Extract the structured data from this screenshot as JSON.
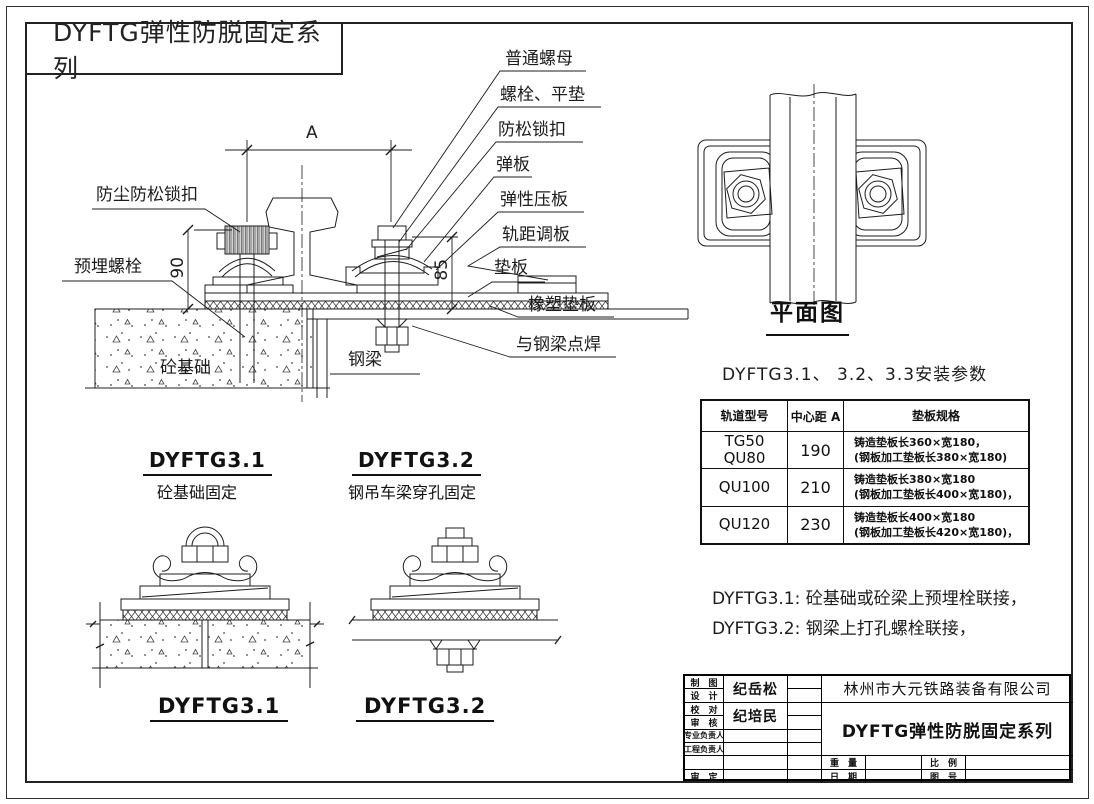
{
  "sheet": {
    "series_title": "DYFTG弹性防脱固定系列"
  },
  "colors": {
    "line": "#1c1c1c",
    "background": "#ffffff"
  },
  "main_view": {
    "callouts": [
      "普通螺母",
      "螺栓、平垫",
      "防松锁扣",
      "弹板",
      "弹性压板",
      "轨距调板",
      "垫板",
      "橡塑垫板",
      "与钢梁点焊"
    ],
    "label_dust_lock": "防尘防松锁扣",
    "label_embed_bolt": "预埋螺栓",
    "label_concrete_foundation": "砼基础",
    "label_steel_beam": "钢梁",
    "dim_span": "A",
    "dim_height_left": "90",
    "dim_height_right": "85"
  },
  "plan_view": {
    "title": "平面图"
  },
  "params": {
    "title": "DYFTG3.1、 3.2、3.3安装参数",
    "col_model": "轨道型号",
    "col_center": "中心距 A",
    "col_spec": "垫板规格",
    "rows": [
      {
        "model1": "TG50",
        "model2": "QU80",
        "center": "190",
        "spec1": "铸造垫板长360×宽180，",
        "spec2": "(钢板加工垫板长380×宽180)"
      },
      {
        "model1": "QU100",
        "model2": "",
        "center": "210",
        "spec1": "铸造垫板长380×宽180",
        "spec2": "(钢板加工垫板长400×宽180)，"
      },
      {
        "model1": "QU120",
        "model2": "",
        "center": "230",
        "spec1": "铸造垫板长400×宽180",
        "spec2": "(钢板加工垫板长420×宽180)，"
      }
    ]
  },
  "notes": {
    "line1": "DYFTG3.1: 砼基础或砼梁上预埋栓联接，",
    "line2": "DYFTG3.2: 钢梁上打孔螺栓联接，"
  },
  "variants": {
    "left": {
      "title": "DYFTG3.1",
      "subtitle": "砼基础固定",
      "footer": "DYFTG3.1"
    },
    "right": {
      "title": "DYFTG3.2",
      "subtitle": "钢吊车梁穿孔固定",
      "footer": "DYFTG3.2"
    }
  },
  "title_block": {
    "row_labels": [
      "制　图",
      "设　计",
      "校　对",
      "审　核",
      "专业负责人",
      "工程负责人",
      "",
      "审　定"
    ],
    "designer_name": "纪岳松",
    "checker_name": "纪培民",
    "company": "林州市大元铁路装备有限公司",
    "drawing_title": "DYFTG弹性防脱固定系列",
    "weight_label": "重　量",
    "scale_label": "比　例",
    "date_label": "日　期",
    "no_label": "图　号"
  }
}
